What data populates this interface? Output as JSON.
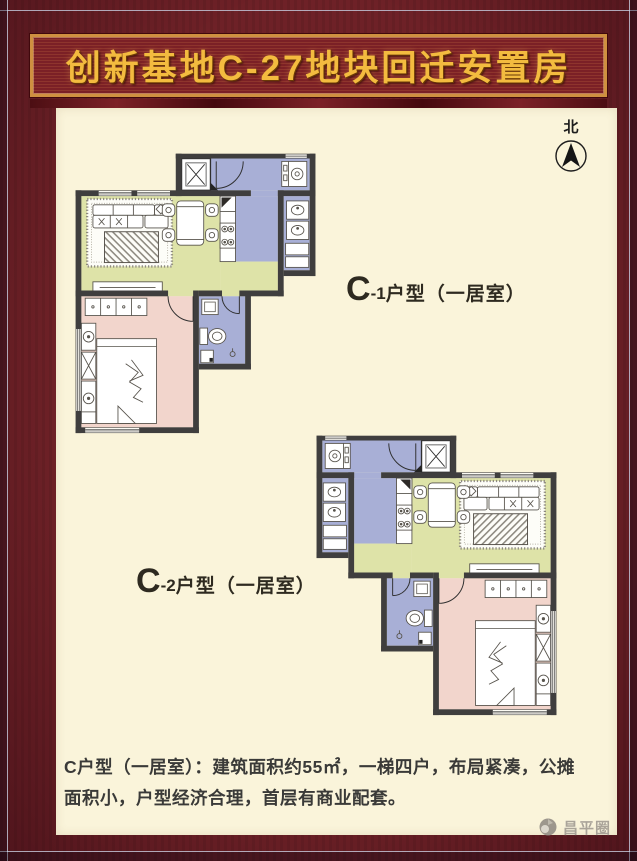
{
  "banner": {
    "title": "创新基地C-27地块回迁安置房"
  },
  "compass": {
    "label": "北"
  },
  "plans": {
    "c1": {
      "prefix": "C",
      "sub": "-1",
      "suffix": "户型（一居室）"
    },
    "c2": {
      "prefix": "C",
      "sub": "-2",
      "suffix": "户型（一居室）"
    }
  },
  "description": {
    "text": "C户型（一居室）：建筑面积约55㎡，一梯四户，布局紧凑，公摊面积小，户型经济合理，首层有商业配套。"
  },
  "watermark": {
    "text": "昌平圈"
  },
  "colors": {
    "frame_maroon": "#6e2127",
    "banner_gold": "#f3bb3f",
    "panel_cream": "#faf4da",
    "wall_dark": "#3f3e3e",
    "living_green": "#dee3a8",
    "bedroom_pink": "#f2d5cc",
    "wet_blue": "#a8afd6"
  }
}
